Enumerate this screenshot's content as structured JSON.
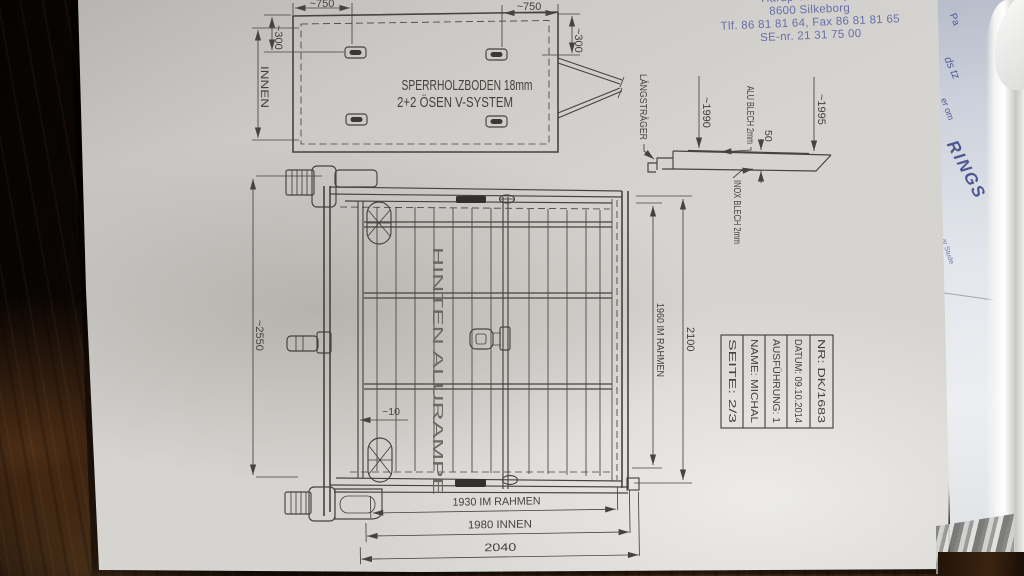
{
  "letterhead": {
    "address_line1": "Hårup Vestervej 9",
    "address_line2": "8600 Silkeborg",
    "address_line3": "Tlf. 86 81 81 64, Fax 86 81 81 65",
    "address_line4": "SE-nr. 21 31 75 00",
    "text_color": "#5d66a5"
  },
  "top_view": {
    "label_line1": "SPERRHOLZBODEN 18mm",
    "label_line2": "2+2 ÖSEN V-SYSTEM",
    "dim_top_left": "~750",
    "dim_top_right": "~750",
    "dim_side_left": "~300",
    "dim_side_right": "~300",
    "dim_innen": "INNEN"
  },
  "side_profile": {
    "label_laengstraeger": "LÄNGSTRÄGER",
    "dim_1990": "~1990",
    "label_alu": "ALU BLECH 2mm",
    "dim_50": "50",
    "dim_1995": "~1995",
    "label_inox": "INOX BLECH 2mm"
  },
  "main_view": {
    "label_ramp": "HINTEN ALURAMPE",
    "dim_height_overall": "~2550",
    "dim_gap": "~10",
    "dim_frame_height": "1960 IM RAHMEN",
    "dim_total_height": "2100",
    "dim_width_frame": "1930 IM RAHMEN",
    "dim_width_inner": "1980 INNEN",
    "dim_width_total": "2040"
  },
  "title_block": {
    "rows": [
      {
        "label": "NR: DK/1683"
      },
      {
        "label": "DATUM: 09.10.2014"
      },
      {
        "label": "AUSFÜHRUNG: 1"
      },
      {
        "label": "NAME: MICHAL"
      },
      {
        "label": "SEITE: 2/3"
      }
    ]
  },
  "side_paper": {
    "fragments": [
      "Pa",
      "ds tz",
      "er om",
      "RINGS",
      "ar Stude"
    ]
  },
  "colors": {
    "ink": "#45433f",
    "paper": "#d6d4d0",
    "blueprint_text": "#5d66a5",
    "wood_dark": "#1a0f07"
  }
}
